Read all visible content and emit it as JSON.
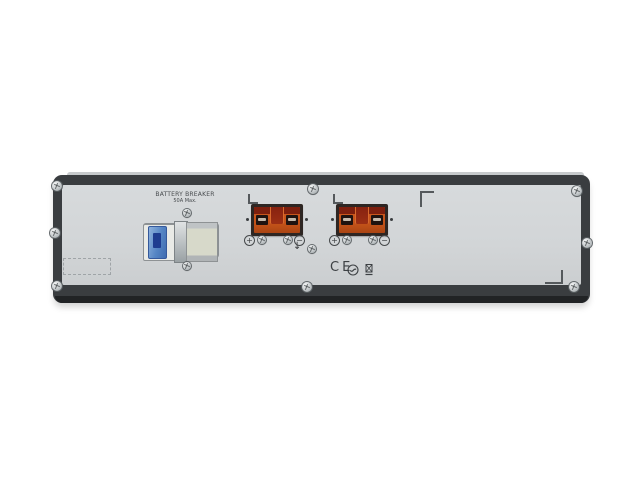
{
  "scene": {
    "type": "product-photo",
    "subject": "Rear panel of a 2U rack-mount UPS external battery pack on white background",
    "background_color": "#ffffff"
  },
  "unit": {
    "chassis_color": "#3a3d40",
    "panel_color": "#d2d5d7",
    "breaker": {
      "label_line1": "BATTERY BREAKER",
      "label_line2": "50A Max.",
      "lever_color": "#4472b8"
    },
    "connectors": {
      "count": 2,
      "housing_color": "#c8551f",
      "insert_color": "#7d1f0e",
      "positive_symbol": "+",
      "negative_symbol": "−"
    },
    "ground_symbol": "↓",
    "certifications": {
      "ce_text": "CE",
      "marks": [
        "c-tick-mark",
        "weee-bin-mark"
      ]
    }
  }
}
